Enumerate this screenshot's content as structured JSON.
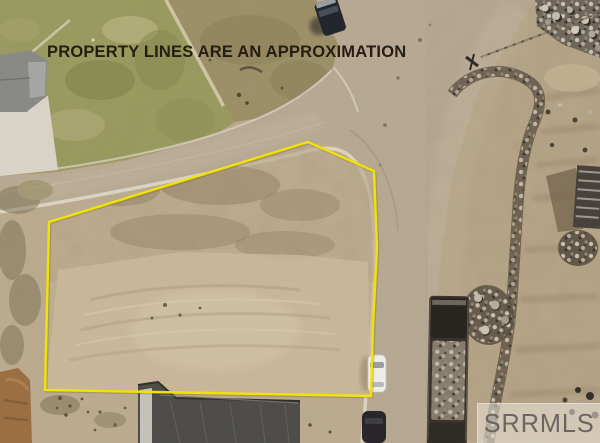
{
  "overlay": {
    "disclaimer": "PROPERTY LINES ARE AN APPROXIMATION",
    "disclaimer_color": "#241d12",
    "property_line_color": "#f2e306",
    "property_line_points": "49,222 308,142 374,171 377,248 373,325 371,396 45,390"
  },
  "watermark": {
    "text": "SRRMLS",
    "text_color": "#5f5d5a",
    "panel_color": "rgba(236,231,220,0.55)"
  }
}
